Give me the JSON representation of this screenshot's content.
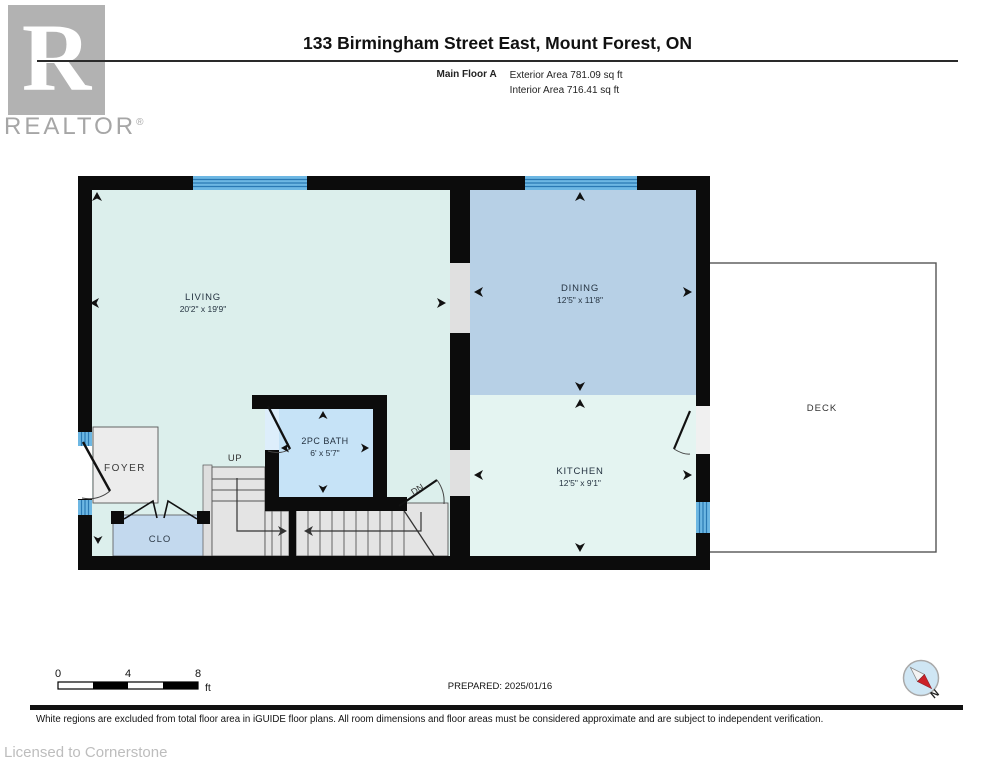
{
  "header": {
    "logo_letter": "R",
    "brand": "REALTOR",
    "registered": "®",
    "title": "133 Birmingham Street East, Mount Forest, ON",
    "floor_label": "Main Floor A",
    "exterior_area": "Exterior Area 781.09 sq ft",
    "interior_area": "Interior Area 716.41 sq ft"
  },
  "plan": {
    "rooms": {
      "living": {
        "name": "LIVING",
        "dims": "20'2\" x 19'9\""
      },
      "dining": {
        "name": "DINING",
        "dims": "12'5\" x 11'8\""
      },
      "kitchen": {
        "name": "KITCHEN",
        "dims": "12'5\" x 9'1\""
      },
      "bath": {
        "name": "2PC BATH",
        "dims": "6' x 5'7\""
      },
      "foyer": {
        "name": "FOYER"
      },
      "closet": {
        "name": "CLO"
      },
      "deck": {
        "name": "DECK"
      }
    },
    "stairs": {
      "up": "UP",
      "down": "DN"
    },
    "colors": {
      "wall": "#0c0c0c",
      "window_blue": "#6db7e3",
      "window_line": "#2a79b3",
      "living_fill": "#dcefec",
      "dining_fill": "#b7d0e6",
      "kitchen_fill": "#e4f4f1",
      "bath_fill": "#c6e3f7",
      "closet_fill": "#c3d9ee",
      "foyer_fill": "#ececec",
      "stair_fill": "#e4e4e4",
      "deck_fill": "#ffffff",
      "compass_red": "#cc2128"
    }
  },
  "footer": {
    "scale": {
      "zero": "0",
      "four": "4",
      "eight": "8",
      "unit": "ft"
    },
    "prepared": "PREPARED: 2025/01/16",
    "compass_label": "N",
    "disclaimer": "White regions are excluded from total floor area in iGUIDE floor plans. All room dimensions and floor areas must be considered approximate and are subject to independent verification.",
    "licensed": "Licensed to Cornerstone"
  }
}
